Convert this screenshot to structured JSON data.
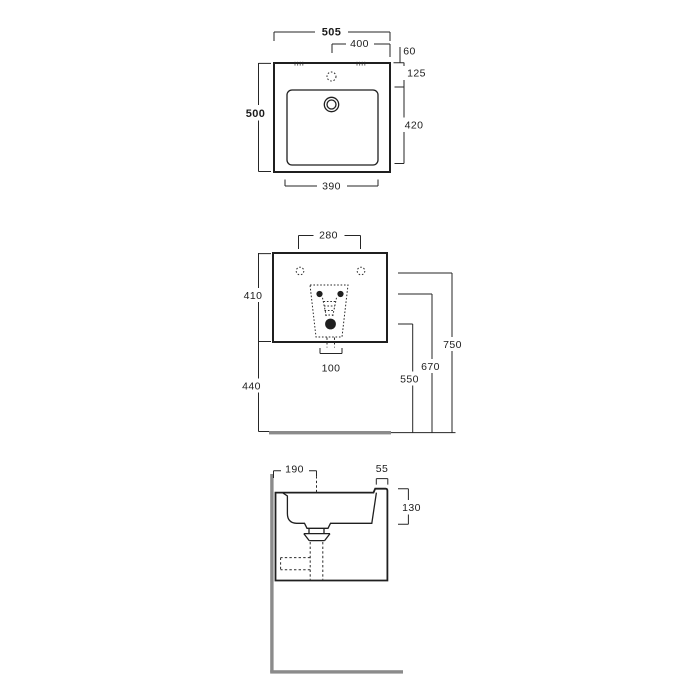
{
  "palette": {
    "line": "#1f1f1f",
    "wall_floor": "#8b8b8b",
    "background": "#ffffff"
  },
  "views": {
    "top": {
      "name": "top view",
      "dims": {
        "overall_width": "505",
        "tap_hole_spacing": "400",
        "edge_to_tap": "60",
        "edge_to_basin": "125",
        "basin_length": "420",
        "overall_depth": "500",
        "basin_width": "390"
      }
    },
    "front": {
      "name": "front view",
      "dims": {
        "fixing_hole_spacing": "280",
        "body_height": "410",
        "body_to_floor": "440",
        "drain_cutout_width": "100",
        "drain_height": "550",
        "bolt_height": "670",
        "fixing_height": "750"
      }
    },
    "side": {
      "name": "side section view",
      "dims": {
        "wall_to_drain": "190",
        "rim_lip_width": "55",
        "basin_depth": "130"
      }
    }
  }
}
